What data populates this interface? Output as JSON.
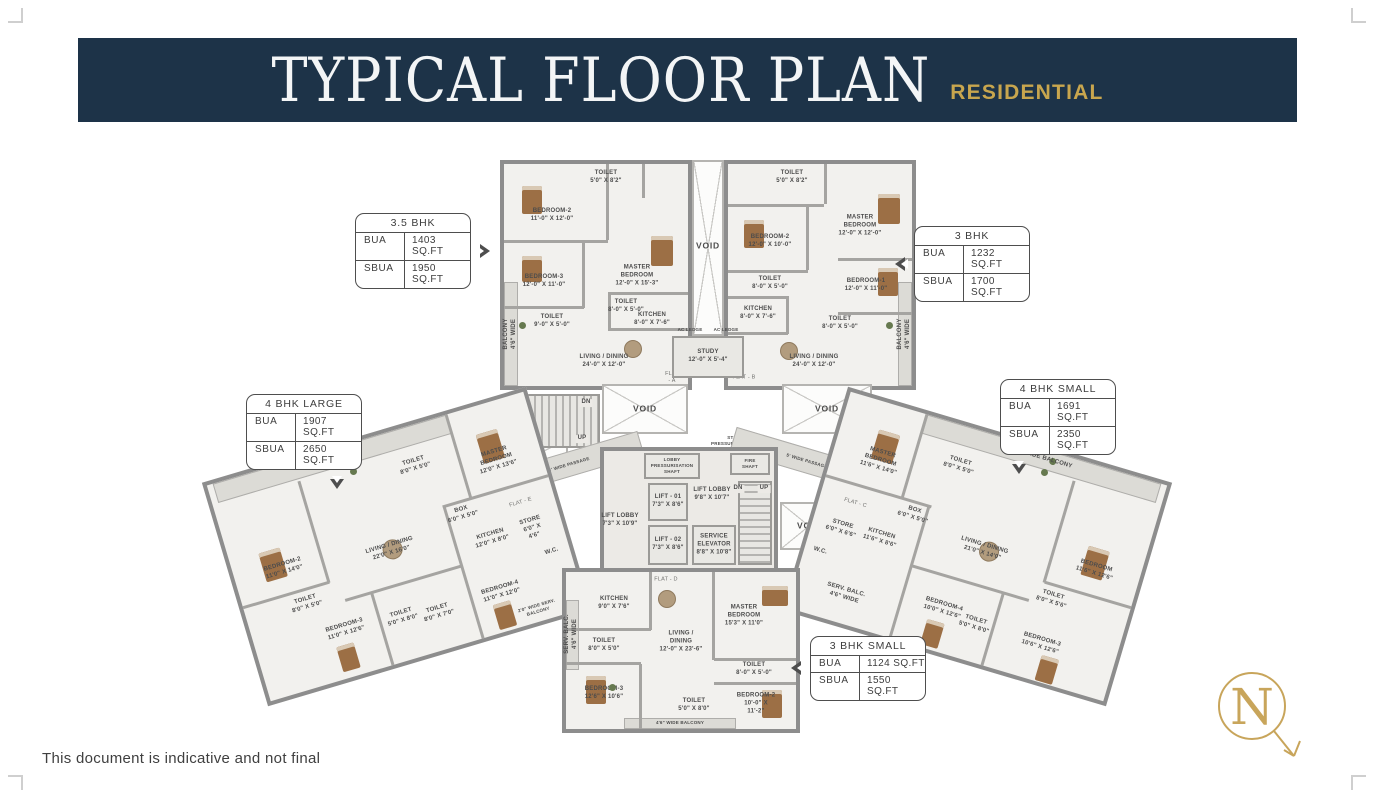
{
  "header": {
    "title": "TYPICAL FLOOR PLAN",
    "subtitle": "RESIDENTIAL"
  },
  "footer": {
    "disclaimer": "This document is indicative and not final"
  },
  "compass": {
    "letter": "N"
  },
  "colors": {
    "header_bg": "#1d3348",
    "gold": "#c8a64e",
    "wall_gray": "#8d8d8d"
  },
  "callouts": {
    "bhk35": {
      "title": "3.5 BHK",
      "bua_label": "BUA",
      "bua_value": "1403 SQ.FT",
      "sbua_label": "SBUA",
      "sbua_value": "1950 SQ.FT"
    },
    "bhk3": {
      "title": "3 BHK",
      "bua_label": "BUA",
      "bua_value": "1232 SQ.FT",
      "sbua_label": "SBUA",
      "sbua_value": "1700 SQ.FT"
    },
    "bhk4l": {
      "title": "4 BHK LARGE",
      "bua_label": "BUA",
      "bua_value": "1907 SQ.FT",
      "sbua_label": "SBUA",
      "sbua_value": "2650 SQ.FT"
    },
    "bhk4s": {
      "title": "4 BHK SMALL",
      "bua_label": "BUA",
      "bua_value": "1691 SQ.FT",
      "sbua_label": "SBUA",
      "sbua_value": "2350 SQ.FT"
    },
    "bhk3s": {
      "title": "3 BHK SMALL",
      "bua_label": "BUA",
      "bua_value": "1124 SQ.FT",
      "sbua_label": "SBUA",
      "sbua_value": "1550 SQ.FT"
    }
  },
  "plan": {
    "flat_a": {
      "tag": "FLAT - A",
      "toilet_top": "TOILET\n5'0\" X 8'2\"",
      "bedroom2": "BEDROOM-2\n11'-0\" X 12'-0\"",
      "master": "MASTER\nBEDROOM\n12'-0\" X 15'-3\"",
      "bedroom3": "BEDROOM-3\n12'-0\" X 11'-0\"",
      "toilet_mid": "TOILET\n8'-0\" X 5'-0\"",
      "toilet_left": "TOILET\n9'-0\" X 5'-0\"",
      "kitchen": "KITCHEN\n8'-0\" X 7'-6\"",
      "living": "LIVING / DINING\n24'-0\" X 12'-0\"",
      "balcony": "BALCONY\n4'6\" WIDE"
    },
    "flat_b": {
      "tag": "FLAT - B",
      "toilet_top": "TOILET\n5'0\" X 8'2\"",
      "bedroom2": "BEDROOM-2\n12'-0\" X 10'-0\"",
      "master": "MASTER\nBEDROOM\n12'-0\" X 12'-0\"",
      "bedroom1": "BEDROOM-1\n12'-0\" X 11'-0\"",
      "toilet_mid": "TOILET\n8'-0\" X 5'-0\"",
      "toilet_low": "TOILET\n8'-0\" X 5'-0\"",
      "kitchen": "KITCHEN\n8'-0\" X 7'-6\"",
      "living": "LIVING / DINING\n24'-0\" X 12'-0\"",
      "balcony": "BALCONY\n4'6\" WIDE"
    },
    "flat_e": {
      "tag": "FLAT - E",
      "balcony": "4'6\" WIDE BALCONY",
      "toilet_top": "TOILET\n8'0\" X 5'0\"",
      "master": "MASTER\nBEDROOM\n12'0\" X 13'6\"",
      "box": "BOX\n6'0\" X 5'0\"",
      "bedroom2": "BEDROOM-2\n11'0\" X 14'0\"",
      "living": "LIVING / DINING\n22'0\" X 16'0\"",
      "kitchen": "KITCHEN\n12'0\" X 8'0\"",
      "store": "STORE\n6'0\" X 4'6\"",
      "wc": "W.C.",
      "toilet_left": "TOILET\n8'0\" X 5'0\"",
      "bedroom3": "BEDROOM-3\n11'0\" X 12'6\"",
      "toilet_c1": "TOILET\n5'0\" X 8'0\"",
      "toilet_c2": "TOILET\n8'0\" X 7'0\"",
      "bedroom4": "BEDROOM-4\n11'0\" X 12'0\"",
      "serv_balcony": "2'0\" WIDE SERV. BALCONY"
    },
    "flat_c": {
      "tag": "FLAT - C",
      "balcony": "4'6\" WIDE BALCONY",
      "toilet_top": "TOILET\n8'0\" X 5'0\"",
      "master": "MASTER\nBEDROOM\n11'6\" X 14'0\"",
      "box": "BOX\n6'0\" X 5'0\"",
      "living": "LIVING / DINING\n21'0\" X 14'0\"",
      "bedroom": "BEDROOM\n11'6\" X 12'6\"",
      "toilet_right": "TOILET\n8'0\" X 5'6\"",
      "store": "STORE\n6'0\" X 6'6\"",
      "wc": "W.C.",
      "kitchen": "KITCHEN\n11'6\" X 8'6\"",
      "serv_balc": "SERV. BALC.\n4'6\" WIDE",
      "bedroom4": "BEDROOM-4\n10'0\" X 12'6\"",
      "toilet_c": "TOILET\n5'0\" X 8'0\"",
      "bedroom3": "BEDROOM-3\n10'6\" X 12'6\""
    },
    "flat_d": {
      "tag": "FLAT - D",
      "kitchen": "KITCHEN\n9'0\" X 7'6\"",
      "serv_balc": "SERV. BALC.\n4'6\" WIDE",
      "toilet_left": "TOILET\n8'0\" X 5'0\"",
      "bedroom3": "BEDROOM-3\n12'6\" X 10'6\"",
      "living": "LIVING /\nDINING\n12'-0\" X 23'-6\"",
      "master": "MASTER\nBEDROOM\n15'3\" X 11'0\"",
      "toilet_right": "TOILET\n8'-0\" X 5'-0\"",
      "bedroom2": "BEDROOM-2\n10'-0\" X 11'-2\"",
      "toilet_c": "TOILET\n5'0\" X 8'0\"",
      "balcony": "4'6\" WIDE BALCONY"
    },
    "core": {
      "lobby_shaft": "LOBBY\nPRESSURISATION\nSHAFT",
      "stair_shaft": "STAIRCASE\nPRESSURISATION SHAFT",
      "lift1": "LIFT - 01\n7'3\" X 8'6\"",
      "lift2": "LIFT - 02\n7'3\" X 8'6\"",
      "lift_lobby": "LIFT LOBBY\n9'8\" X 10'7\"",
      "lift_lobby2": "LIFT LOBBY\n7'3\" X 10'9\"",
      "service_elevator": "SERVICE\nELEVATOR\n8'8\" X 10'8\"",
      "fire_shaft": "FIRE SHAFT",
      "dn": "DN",
      "up": "UP",
      "void": "VOID",
      "passage": "5' WIDE PASSAGE",
      "ac_ledge": "AC LEDGE",
      "study": "STUDY\n12'-0\" X 5'-4\""
    }
  }
}
